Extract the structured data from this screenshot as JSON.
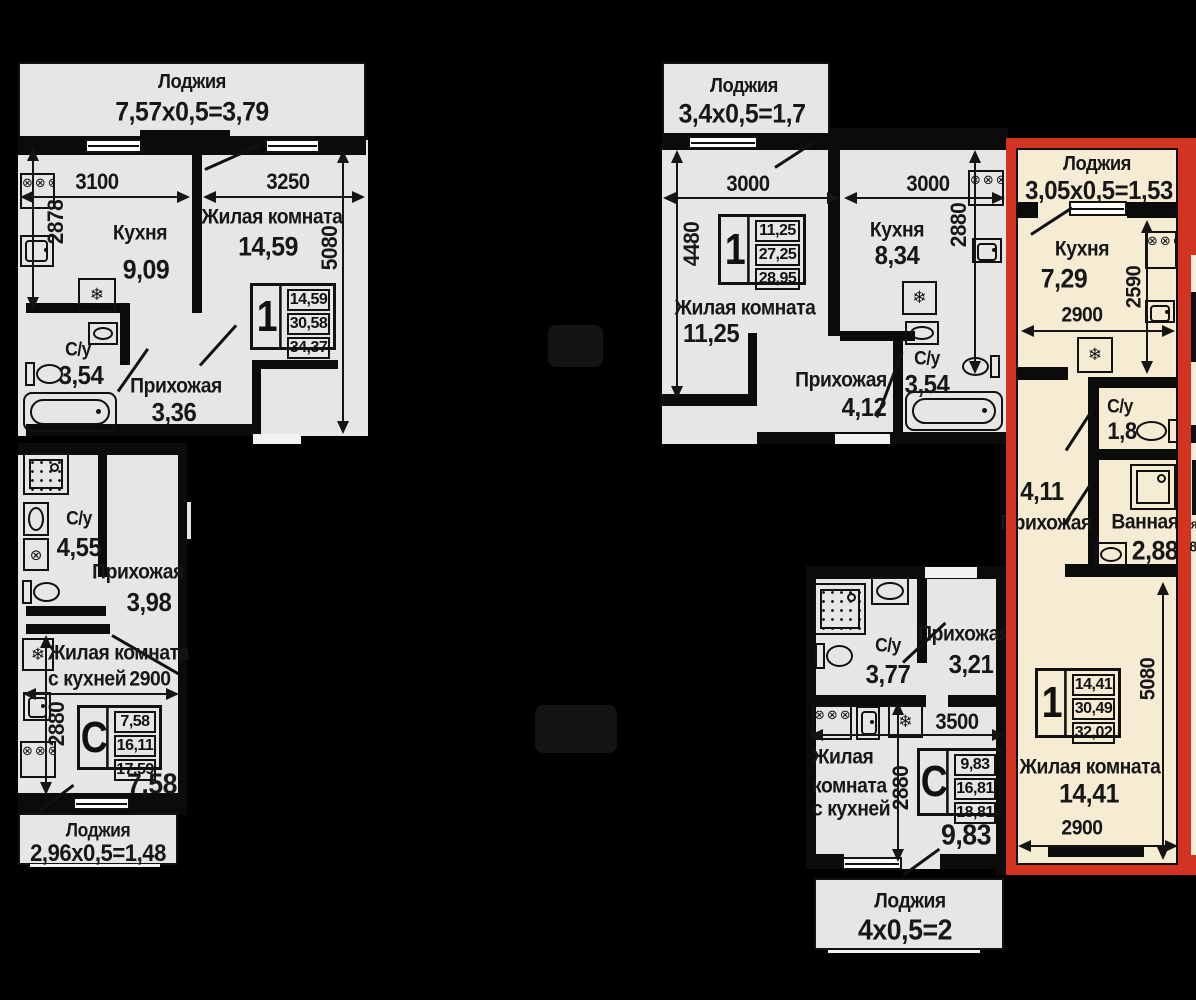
{
  "colors": {
    "background": "#000000",
    "unit_fill": "#e6e6e6",
    "highlight_fill": "#f5ecd3",
    "highlight_border": "#d33422",
    "line": "#111111"
  },
  "icons": {
    "burners": "⊗⊗⊗⊗",
    "snowflake": "❄",
    "washer_drum": "⊗"
  },
  "edge": {
    "g1": "я",
    "g2": "8"
  },
  "units": {
    "tl": {
      "loggia_name": "Лоджия",
      "loggia_calc": "7,57х0,5=3,79",
      "dim_w_kitchen": "3100",
      "dim_w_living": "3250",
      "dim_h_kitchen": "2878",
      "dim_h_living": "5080",
      "kitchen": "Кухня",
      "kitchen_area": "9,09",
      "living": "Жилая комната",
      "living_area": "14,59",
      "wc": "С/у",
      "wc_area": "3,54",
      "hall": "Прихожая",
      "hall_area": "3,36",
      "card": {
        "type": "1",
        "r1": "14,59",
        "r2": "30,58",
        "r3": "34,37"
      }
    },
    "tm": {
      "loggia_name": "Лоджия",
      "loggia_calc": "3,4х0,5=1,7",
      "dim_w_living": "3000",
      "dim_w_kitchen": "3000",
      "dim_h_living": "4480",
      "dim_h_kitchen": "2880",
      "living": "Жилая комната",
      "living_area": "11,25",
      "kitchen": "Кухня",
      "kitchen_area": "8,34",
      "hall": "Прихожая",
      "hall_area": "4,12",
      "wc": "С/у",
      "wc_area": "3,54",
      "card": {
        "type": "1",
        "r1": "11,25",
        "r2": "27,25",
        "r3": "28,95"
      }
    },
    "bl": {
      "wc": "С/у",
      "wc_area": "4,55",
      "hall": "Прихожая",
      "hall_area": "3,98",
      "living_l1": "Жилая комната",
      "living_l2": "с кухней",
      "dim_w": "2900",
      "dim_h": "2880",
      "area_big": "7,58",
      "loggia_name": "Лоджия",
      "loggia_calc": "2,96х0,5=1,48",
      "card": {
        "type": "С",
        "r1": "7,58",
        "r2": "16,11",
        "r3": "17,59"
      }
    },
    "bm": {
      "wc": "С/у",
      "wc_area": "3,77",
      "hall": "Прихожая",
      "hall_area": "3,21",
      "dim_w": "3500",
      "dim_h": "2880",
      "living_l1": "Жилая",
      "living_l2": "комната",
      "living_l3": "с кухней",
      "area_big": "9,83",
      "loggia_name": "Лоджия",
      "loggia_calc": "4х0,5=2",
      "card": {
        "type": "С",
        "r1": "9,83",
        "r2": "16,81",
        "r3": "18,81"
      }
    },
    "hl": {
      "loggia_name": "Лоджия",
      "loggia_calc": "3,05х0,5=1,53",
      "kitchen": "Кухня",
      "kitchen_area": "7,29",
      "dim_w_top": "2900",
      "dim_h_kitchen": "2590",
      "wc": "С/у",
      "wc_area": "1,8",
      "hall": "Прихожая",
      "hall_area": "4,11",
      "bath": "Ванная",
      "bath_area": "2,88",
      "living": "Жилая комната",
      "living_area": "14,41",
      "dim_w_bottom": "2900",
      "dim_h_living": "5080",
      "card": {
        "type": "1",
        "r1": "14,41",
        "r2": "30,49",
        "r3": "32,02"
      }
    }
  }
}
